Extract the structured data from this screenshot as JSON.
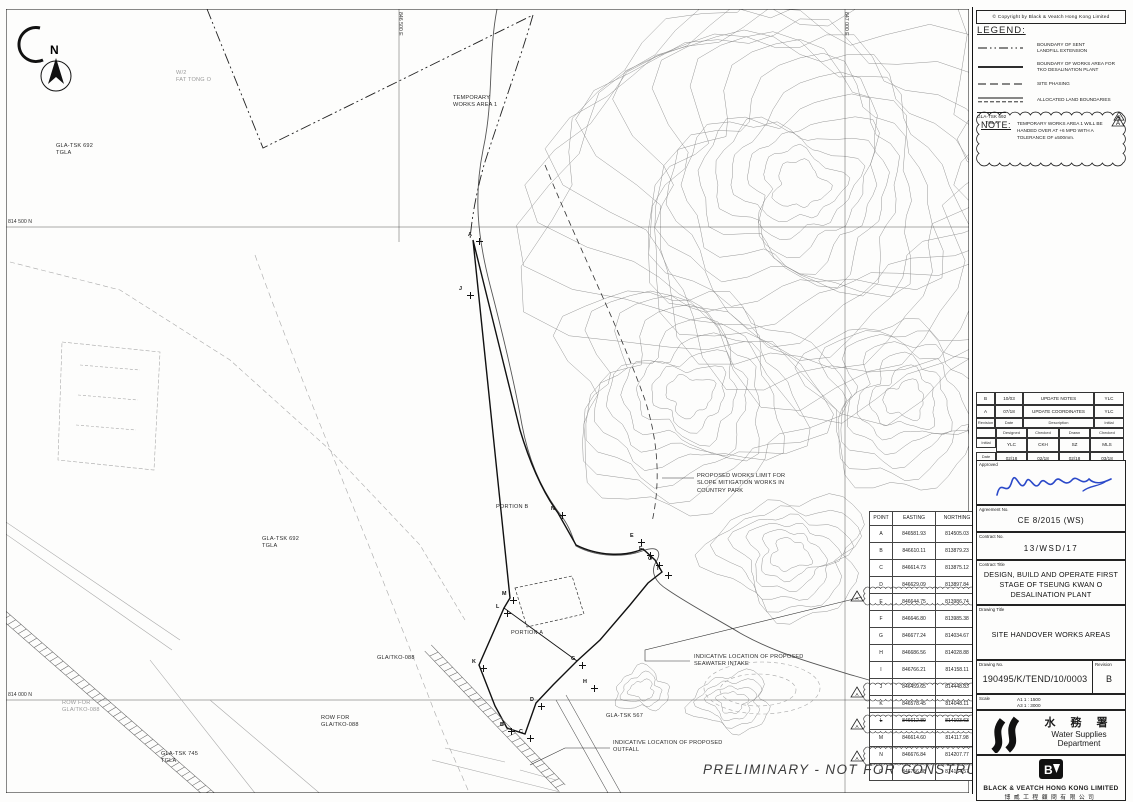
{
  "sheet": {
    "copyright": "©  Copyright by Black & Veatch Hong Kong Limited",
    "watermark": "PRELIMINARY  -  NOT FOR CONSTRUCTION"
  },
  "legend": {
    "title": "LEGEND:",
    "items": [
      {
        "style": "dashdot",
        "label": "BOUNDARY OF SENT\nLANDFILL EXTENSION"
      },
      {
        "style": "solid",
        "label": "BOUNDARY OF WORKS AREA FOR\nTKO DESALINATION PLANT"
      },
      {
        "style": "dashed",
        "label": "SITE PHASING"
      },
      {
        "style": "allocated",
        "label": "ALLOCATED LAND BOUNDARIES"
      }
    ],
    "land_parcel_sample": "GLA-TSK 692\nTGLA",
    "revision_triangle": "A"
  },
  "note": {
    "title": "NOTE:",
    "text": "TEMPORARY WORKS AREA 1 WILL BE HANDED OVER AT +6 MPD WITH A TOLERANCE OF ±500mm.",
    "marker": "B"
  },
  "revision_table": {
    "rows": [
      {
        "rev": "B",
        "date": "10/03",
        "description": "UPDATE NOTES",
        "initial": "YLC"
      },
      {
        "rev": "A",
        "date": "07/18",
        "description": "UPDATE COORDINATES",
        "initial": "YLC"
      }
    ],
    "headers": [
      "Revision",
      "Date",
      "Description",
      "Initial"
    ],
    "staff_headers": [
      "",
      "Designed",
      "Checked",
      "Drawn",
      "Checked"
    ],
    "staff_rows": [
      {
        "label": "Initial",
        "values": [
          "YLC",
          "CKH",
          "SZ",
          "MLS"
        ]
      },
      {
        "label": "Date",
        "values": [
          "02/18",
          "02/18",
          "02/18",
          "03/18"
        ]
      }
    ]
  },
  "title_block": {
    "approved_label": "Approved",
    "agreement_label": "Agreement No.",
    "agreement_no": "CE 8/2015 (WS)",
    "contract_label": "Contract No.",
    "contract_no": "13/WSD/17",
    "contract_title_label": "Contract Title",
    "contract_title": "DESIGN, BUILD AND OPERATE FIRST STAGE OF TSEUNG KWAN O DESALINATION PLANT",
    "drawing_title_label": "Drawing Title",
    "drawing_title": "SITE HANDOVER WORKS AREAS",
    "drawing_no_label": "Drawing No.",
    "drawing_no": "190495/K/TEND/10/0003",
    "revision_label": "Revision",
    "revision": "B",
    "scale_label": "Scale",
    "scale_a1": "A1 1 : 1500",
    "scale_a3": "A3 1 : 3000",
    "wsd_chinese": "水 務 署",
    "wsd_english": "Water Supplies Department",
    "bv_name": "BLACK & VEATCH HONG KONG LIMITED",
    "bv_chinese": "博威工程顧問有限公司"
  },
  "coordinate_table": {
    "headers": [
      "POINT",
      "EASTING",
      "NORTHING"
    ],
    "rows": [
      {
        "point": "A",
        "easting": "846581.93",
        "northing": "814505.03"
      },
      {
        "point": "B",
        "easting": "846610.11",
        "northing": "813879.23"
      },
      {
        "point": "C",
        "easting": "846614.73",
        "northing": "813875.12"
      },
      {
        "point": "D",
        "easting": "846629.09",
        "northing": "813897.84"
      },
      {
        "point": "E",
        "easting": "846644.75",
        "northing": "813986.74",
        "clouded": true,
        "marker": "A"
      },
      {
        "point": "F",
        "easting": "846646.80",
        "northing": "813985.38"
      },
      {
        "point": "G",
        "easting": "846677.24",
        "northing": "814034.67"
      },
      {
        "point": "H",
        "easting": "846686.56",
        "northing": "814028.88"
      },
      {
        "point": "I",
        "easting": "846766.21",
        "northing": "814158.11"
      },
      {
        "point": "J",
        "easting": "846459.65",
        "northing": "814448.83"
      },
      {
        "point": "K",
        "easting": "846578.45",
        "northing": "814048.11",
        "clouded": true,
        "marker": "A"
      },
      {
        "point": "L",
        "easting": "846612.89",
        "northing": "814103.63",
        "struck": true
      },
      {
        "point": "M",
        "easting": "846614.60",
        "northing": "814117.98",
        "clouded": true,
        "marker": "A"
      },
      {
        "point": "N",
        "easting": "846676.84",
        "northing": "814207.77"
      },
      {
        "point": "O",
        "easting": "846756.88",
        "northing": "814164.57",
        "clouded": true,
        "marker": "A"
      }
    ]
  },
  "map": {
    "north_label": "N",
    "grid_labels": [
      {
        "text": "814 500 N",
        "x": 8,
        "y": 219,
        "vertical": false
      },
      {
        "text": "814 000 N",
        "x": 8,
        "y": 692,
        "vertical": false
      },
      {
        "text": "846 500 E",
        "x": 403,
        "y": 12,
        "vertical": true
      },
      {
        "text": "847 000 E",
        "x": 849,
        "y": 12,
        "vertical": true
      }
    ],
    "labels": [
      {
        "text": "TEMPORARY\nWORKS AREA 1",
        "x": 453,
        "y": 95
      },
      {
        "text": "GLA-TSK 692\nTGLA",
        "x": 56,
        "y": 143
      },
      {
        "text": "W/2\nFAT TONG O",
        "x": 176,
        "y": 70,
        "faint": true
      },
      {
        "text": "GLA-TSK 692\nTGLA",
        "x": 262,
        "y": 536
      },
      {
        "text": "PORTION B",
        "x": 496,
        "y": 504
      },
      {
        "text": "PORTION A",
        "x": 511,
        "y": 630
      },
      {
        "text": "GLA/TKO-088",
        "x": 377,
        "y": 655
      },
      {
        "text": "ROW FOR\nGLA/TKO-088",
        "x": 321,
        "y": 715
      },
      {
        "text": "ROW FOR\nGLA/TKO-088",
        "x": 62,
        "y": 700,
        "faint": true
      },
      {
        "text": "GLA-TSK 745\nTGLA",
        "x": 161,
        "y": 751
      },
      {
        "text": "GLA-TSK 567",
        "x": 606,
        "y": 713
      },
      {
        "text": "PROPOSED WORKS LIMIT FOR\nSLOPE MITIGATION WORKS IN\nCOUNTRY PARK",
        "x": 697,
        "y": 473
      },
      {
        "text": "INDICATIVE LOCATION OF PROPOSED\nSEAWATER INTAKE",
        "x": 694,
        "y": 654
      },
      {
        "text": "INDICATIVE LOCATION OF PROPOSED\nOUTFALL",
        "x": 613,
        "y": 740
      }
    ],
    "points": [
      {
        "label": "A",
        "x": 468,
        "y": 232
      },
      {
        "label": "J",
        "x": 459,
        "y": 286
      },
      {
        "label": "N",
        "x": 551,
        "y": 506
      },
      {
        "label": "E",
        "x": 630,
        "y": 533
      },
      {
        "label": "F",
        "x": 639,
        "y": 546
      },
      {
        "label": "O",
        "x": 648,
        "y": 556
      },
      {
        "label": "I",
        "x": 657,
        "y": 566
      },
      {
        "label": "M",
        "x": 502,
        "y": 591
      },
      {
        "label": "L",
        "x": 496,
        "y": 604
      },
      {
        "label": "G",
        "x": 571,
        "y": 656
      },
      {
        "label": "H",
        "x": 583,
        "y": 679
      },
      {
        "label": "K",
        "x": 472,
        "y": 659
      },
      {
        "label": "D",
        "x": 530,
        "y": 697
      },
      {
        "label": "B",
        "x": 500,
        "y": 722
      },
      {
        "label": "C",
        "x": 519,
        "y": 729
      }
    ]
  }
}
